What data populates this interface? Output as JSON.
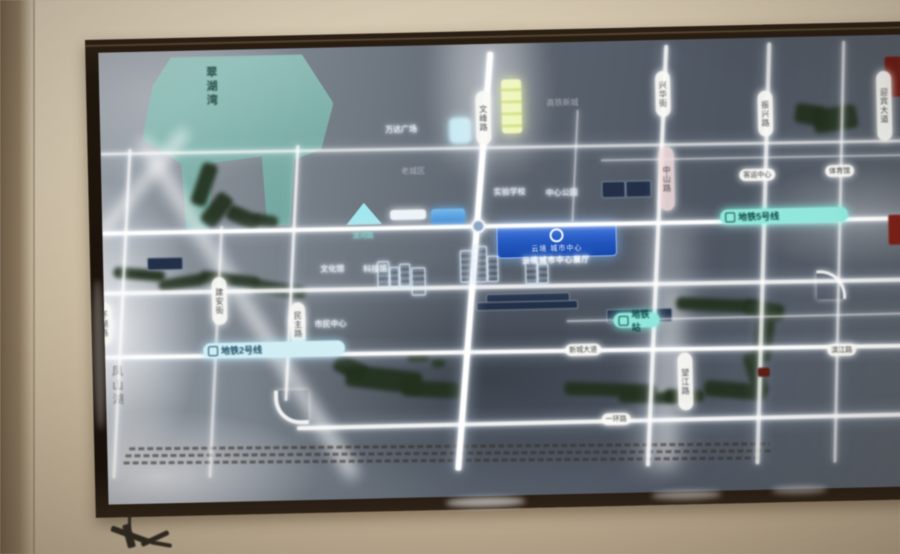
{
  "display": {
    "badge": {
      "name": "云境 城市中心",
      "subtitle": "云境城市中心展厅"
    },
    "lake_label": "翠湖湾",
    "wall_label": "凤山湖",
    "colors": {
      "wall": "#cbbb9f",
      "bezel": "#1f160d",
      "map_deep": "#4e5663",
      "map_wash": "#9aa1a9",
      "road_white": "#ffffff",
      "metro_teal": "#8fe8dd",
      "metro_blue": "#cfeef5",
      "badge_blue": "#1d56c8",
      "park_green": "#22301d",
      "lake_teal": "#7db5ac",
      "landmark_yellow": "#dcea83",
      "landmark_blue": "#2e7fd0",
      "red_label": "#6e1a12"
    },
    "metro_lines": [
      {
        "text": "地铁2号线",
        "x": 98,
        "y": 293,
        "w": 142,
        "style": "blue"
      },
      {
        "text": "地铁5号线",
        "x": 618,
        "y": 171,
        "w": 128,
        "style": "teal"
      },
      {
        "text": "地铁站",
        "x": 509,
        "y": 272,
        "w": 46,
        "style": "teal"
      }
    ],
    "road_pills_vertical": [
      {
        "text": "文峰路",
        "x": 376,
        "y": 47,
        "h": 46
      },
      {
        "text": "兴华街",
        "x": 556,
        "y": 31,
        "h": 38
      },
      {
        "text": "振兴路",
        "x": 658,
        "y": 53,
        "h": 38
      },
      {
        "text": "迎宾大道",
        "x": 777,
        "y": 36,
        "h": 62
      },
      {
        "text": "建安街",
        "x": 108,
        "y": 227,
        "h": 40
      },
      {
        "text": "民主路",
        "x": 186,
        "y": 254,
        "h": 36
      },
      {
        "text": "望江路",
        "x": 572,
        "y": 313,
        "h": 50
      },
      {
        "text": "中山路",
        "x": 558,
        "y": 107,
        "h": 56,
        "pink": true
      },
      {
        "text": "环湖路",
        "x": -8,
        "y": 250,
        "h": 34
      }
    ],
    "labels_glow": [
      {
        "text": "万达广场",
        "x": 285,
        "y": 78
      },
      {
        "text": "实验学校",
        "x": 392,
        "y": 143
      },
      {
        "text": "中心公园",
        "x": 444,
        "y": 145
      },
      {
        "text": "文化馆",
        "x": 217,
        "y": 216
      },
      {
        "text": "科技馆",
        "x": 260,
        "y": 217
      },
      {
        "text": "市民中心",
        "x": 210,
        "y": 271
      }
    ],
    "labels_gray": [
      {
        "text": "老城区",
        "x": 300,
        "y": 120
      },
      {
        "text": "高铁新城",
        "x": 447,
        "y": 55
      }
    ],
    "labels_pill": [
      {
        "text": "客运中心",
        "x": 638,
        "y": 131
      },
      {
        "text": "体育馆",
        "x": 724,
        "y": 129
      },
      {
        "text": "新城大道",
        "x": 460,
        "y": 302
      },
      {
        "text": "一环路",
        "x": 495,
        "y": 372
      },
      {
        "text": "滨江路",
        "x": 722,
        "y": 308
      }
    ],
    "labels_teal": [
      {
        "text": "滨河路",
        "x": 250,
        "y": 184
      }
    ],
    "roads": {
      "horizontal": [
        {
          "x": 0,
          "y": 100,
          "len": 814,
          "w": 2.5,
          "o": 0.7,
          "r": 0.35
        },
        {
          "x": 500,
          "y": 118,
          "len": 314,
          "w": 2,
          "o": 0.5,
          "r": 0.3
        },
        {
          "x": 0,
          "y": 179,
          "len": 814,
          "w": 4,
          "o": 1,
          "r": 0.2
        },
        {
          "x": 0,
          "y": 239,
          "len": 814,
          "w": 3.5,
          "o": 0.88,
          "r": 0.3
        },
        {
          "x": 462,
          "y": 278,
          "len": 352,
          "w": 2,
          "o": 0.55,
          "r": 0
        },
        {
          "x": 0,
          "y": 303,
          "len": 814,
          "w": 4,
          "o": 0.98,
          "r": 0.45
        },
        {
          "x": 190,
          "y": 378,
          "len": 624,
          "w": 3.5,
          "o": 0.92,
          "r": 0
        }
      ],
      "vertical": [
        {
          "x": 28,
          "y": 97,
          "len": 330,
          "w": 3,
          "o": 0.75,
          "r": 4.1
        },
        {
          "x": 118,
          "y": 176,
          "len": 252,
          "w": 2.5,
          "o": 0.6,
          "r": 4
        },
        {
          "x": 196,
          "y": 97,
          "len": 256,
          "w": 3,
          "o": 0.8,
          "r": 4
        },
        {
          "x": 389,
          "y": 8,
          "len": 420,
          "w": 5.5,
          "o": 1,
          "r": 5.7
        },
        {
          "x": 477,
          "y": 68,
          "len": 112,
          "w": 2,
          "o": 0.5,
          "r": 4
        },
        {
          "x": 566,
          "y": 5,
          "len": 422,
          "w": 3.5,
          "o": 0.88,
          "r": 3.8
        },
        {
          "x": 669,
          "y": 5,
          "len": 422,
          "w": 3.5,
          "o": 0.8,
          "r": 2.9
        },
        {
          "x": 744,
          "y": 5,
          "len": 422,
          "w": 2.5,
          "o": 0.65,
          "r": 2.5
        }
      ],
      "corners": [
        {
          "x": 168,
          "y": 342,
          "size": 30,
          "type": "bl"
        },
        {
          "x": 713,
          "y": 234,
          "size": 26,
          "type": "tr"
        }
      ]
    },
    "parks": [
      [
        95,
        112,
        16,
        44,
        20
      ],
      [
        106,
        142,
        18,
        36,
        38
      ],
      [
        124,
        160,
        34,
        16,
        25
      ],
      [
        150,
        166,
        26,
        12,
        10
      ],
      [
        10,
        217,
        52,
        11,
        6
      ],
      [
        55,
        226,
        46,
        12,
        -8
      ],
      [
        96,
        224,
        60,
        12,
        8
      ],
      [
        148,
        234,
        54,
        13,
        10
      ],
      [
        572,
        260,
        84,
        13,
        4
      ],
      [
        640,
        264,
        40,
        16,
        12
      ],
      [
        650,
        276,
        18,
        48,
        8
      ],
      [
        642,
        314,
        16,
        44,
        -14
      ],
      [
        598,
        344,
        62,
        16,
        6
      ],
      [
        558,
        350,
        40,
        12,
        3
      ],
      [
        695,
        68,
        30,
        20,
        10
      ],
      [
        713,
        71,
        44,
        24,
        -8
      ],
      [
        228,
        312,
        34,
        18,
        28
      ],
      [
        240,
        322,
        76,
        22,
        8
      ],
      [
        296,
        336,
        58,
        16,
        4
      ],
      [
        302,
        308,
        22,
        8,
        0
      ],
      [
        326,
        314,
        14,
        8,
        0
      ],
      [
        458,
        342,
        92,
        13,
        3
      ],
      [
        512,
        352,
        62,
        11,
        2
      ]
    ],
    "navy_boxes": [
      [
        44,
        206,
        34,
        11
      ],
      [
        500,
        140,
        22,
        15
      ],
      [
        524,
        140,
        24,
        15
      ],
      [
        382,
        250,
        82,
        8
      ],
      [
        372,
        258,
        100,
        7
      ],
      [
        502,
        268,
        64,
        12
      ]
    ],
    "red_marks": [
      [
        786,
        22,
        16,
        40,
        "#6e1a12"
      ],
      [
        786,
        180,
        16,
        30,
        "#7e2016"
      ],
      [
        808,
        14,
        8,
        190,
        "#581410"
      ],
      [
        652,
        330,
        12,
        9,
        "#5f1d14"
      ]
    ],
    "buildings": [
      [
        274,
        215,
        10,
        24
      ],
      [
        286,
        221,
        8,
        18
      ],
      [
        296,
        218,
        9,
        21
      ],
      [
        308,
        222,
        12,
        26
      ],
      [
        357,
        206,
        11,
        30
      ],
      [
        370,
        202,
        12,
        34
      ],
      [
        384,
        212,
        9,
        24
      ],
      [
        422,
        217,
        10,
        22
      ],
      [
        434,
        221,
        9,
        18
      ]
    ],
    "stations": [
      [
        369,
        175
      ],
      [
        185,
        266
      ],
      [
        -6,
        266
      ]
    ]
  }
}
